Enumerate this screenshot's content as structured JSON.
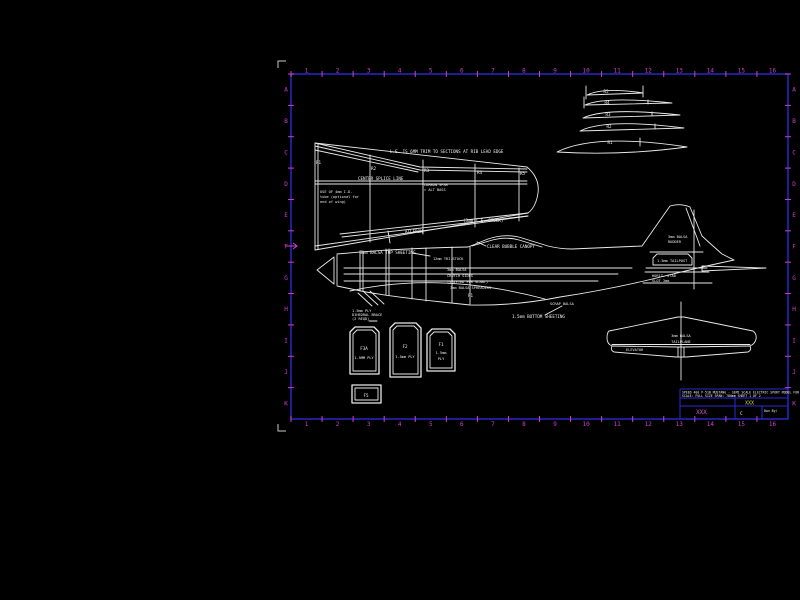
{
  "border": {
    "frame_color": "#2a2ad6",
    "tick_color": "#cf3fcf",
    "ruler_numbers": [
      "1",
      "2",
      "3",
      "4",
      "5",
      "6",
      "7",
      "8",
      "9",
      "10",
      "11",
      "12",
      "13",
      "14",
      "15",
      "16"
    ],
    "side_letters": [
      "A",
      "B",
      "C",
      "D",
      "E",
      "F",
      "G",
      "H",
      "I",
      "J",
      "K"
    ]
  },
  "wing_plan": {
    "le_note": "L.E. IS 6MM TRIM TO SECTIONS AT RIB LEAD EDGE",
    "splice_note": "CENTER SPLICE LINE",
    "ribs": [
      "R1",
      "R2",
      "R3",
      "R4",
      "R5"
    ],
    "tube_note": [
      "USE OF 4mm I.D.",
      "tube (optional for",
      "end of wing)"
    ],
    "spar_note": [
      "CARBON SPAR",
      "= ALT BASS"
    ],
    "te_note": "(3mm T.E. STOCK)",
    "aileron_label": "AILERON"
  },
  "airfoil_stack": {
    "labels": [
      "R5",
      "R4",
      "R3",
      "R2",
      "R1"
    ]
  },
  "fuselage": {
    "top_sheet_note": "3mm BALSA TOP SHEETING",
    "canopy_note": "CLEAR BUBBLE CANOPY",
    "tri_note": "12mm TRI-STOCK",
    "crutch_note": [
      "3mm BALSA",
      "CRUTCH SIDES",
      "(SHIFTED FOR SLANT)"
    ],
    "spreader_note": "3mm BALSA SPREADERS",
    "f1_label": "F1",
    "scrap_note": "SCRAP BALSA",
    "bottom_note": "1.5mm BOTTOM SHEETING",
    "fin_note": [
      "3mm BALSA",
      "RUDDER"
    ],
    "tailpost_note": "1.5mm TAILPOST",
    "slot_note": [
      "HORIZ. STAB",
      "SLOT 3mm"
    ],
    "nose_note": [
      "1.5mm PLY",
      "DIHEDRAL BRACE",
      "(2 REQD)"
    ]
  },
  "stab": {
    "center_note": [
      "3mm BALSA",
      "TAILPLANE"
    ],
    "elevator_label": "ELEVATOR"
  },
  "formers": {
    "f3a_name": "F3A",
    "f3a_mat": "1.5MM PLY",
    "f2_name": "F2",
    "f2_mat": "1.5mm PLY",
    "f1_name": "F1",
    "f1_mat1": "1.5mm",
    "f1_mat2": "PLY",
    "f5_name": "F5"
  },
  "title_block": {
    "line1": "SPEED 400 P-51B MUSTANG - SEMI SCALE ELECTRIC SPORT MODEL FOR PARK FLYING",
    "line2": "SCALE: FULL SIZE   SPAN: 780mm   SHEET 1 OF 2",
    "field_left": "XXX",
    "field_right": "XXX",
    "rev": "C",
    "dwn_by": "Dwn By/",
    "field_left_color": "#e14ae1",
    "field_right_color": "#d8d820"
  }
}
